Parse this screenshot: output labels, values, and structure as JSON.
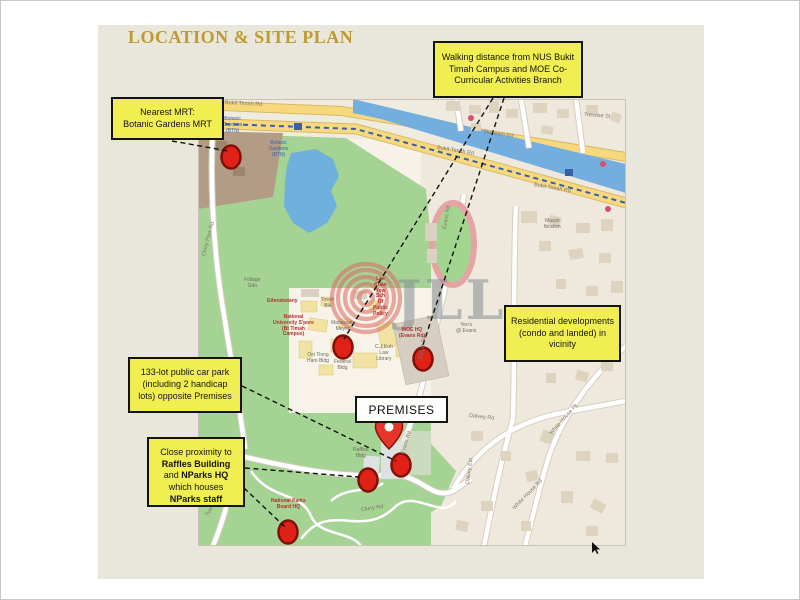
{
  "page": {
    "title": "LOCATION & SITE PLAN"
  },
  "premises": {
    "label": "PREMISES"
  },
  "callouts": {
    "nearest_mrt": {
      "text": "Nearest MRT:\nBotanic Gardens MRT"
    },
    "walking_distance": {
      "text": "Walking distance from NUS Bukit Timah Campus and MOE Co-Curricular Activities Branch"
    },
    "residential": {
      "text": "Residential developments (condo and landed) in vicinity"
    },
    "car_park": {
      "text": "133-lot public car park (including 2 handicap lots) opposite Premises"
    },
    "proximity": {
      "segments": [
        {
          "text": "Close proximity to ",
          "bold": false
        },
        {
          "text": "Raffles Building",
          "bold": true
        },
        {
          "text": " and ",
          "bold": false
        },
        {
          "text": "NParks HQ",
          "bold": true
        },
        {
          "text": " which houses ",
          "bold": false
        },
        {
          "text": "NParks staff",
          "bold": true
        }
      ]
    }
  },
  "map": {
    "watermark": "JLL",
    "labels": [
      {
        "text": "Bukit Timah Rd"
      },
      {
        "text": "Dunearn Rd"
      },
      {
        "text": "Bukit Timah Rd"
      },
      {
        "text": "Bukit Timah Rd"
      },
      {
        "text": "Evans Rd"
      },
      {
        "text": "Evans Rd"
      },
      {
        "text": "Evans Rd"
      },
      {
        "text": "Cluny Rd"
      },
      {
        "text": "Cluny Park Rd"
      },
      {
        "text": "Tyersall Ave"
      },
      {
        "text": "Dalvey Rd"
      },
      {
        "text": "Dalvey Est"
      },
      {
        "text": "White House Pk"
      },
      {
        "text": "White House Rd"
      },
      {
        "text": "Trevose St"
      },
      {
        "text": "Foliage\nGdn"
      },
      {
        "text": "Tower\nBlk"
      },
      {
        "text": "Manasseh\nMeyer"
      },
      {
        "text": "Federal\nBldg"
      },
      {
        "text": "Oei Tiong\nHam Bldg"
      },
      {
        "text": "C.J Koh\nLaw\nLibrary"
      },
      {
        "text": "Yeo's\n@ Evans"
      },
      {
        "text": "Raffles\nBldg"
      },
      {
        "text": "Masjid\nIbrahim"
      },
      {
        "text": "National\nUniversity S'pore\n(Bt Timah\nCampus)"
      },
      {
        "text": "Lee\nKuan\nYew\nSch\nOf\nPublic\nPolicy"
      },
      {
        "text": "MOE HQ\n(Evans Rd)"
      },
      {
        "text": "National Parks\nBoard HQ"
      },
      {
        "text": "Ethnobotany"
      },
      {
        "text": "Botanic\nGardens\n(BTN)"
      },
      {
        "text": "Botanic\nGardens\n(BTN)"
      }
    ]
  },
  "colors": {
    "slide_bg": "#e9e6db",
    "title_gold": "#bf9a2e",
    "callout_yellow": "#f1ee52",
    "park_green": "#a5d394",
    "water_blue": "#74aede",
    "main_road_yellow": "#f6d97e",
    "marker_red": "#e02117",
    "brown_zone": "#b39c85",
    "residential_beige": "#efe9dd"
  }
}
